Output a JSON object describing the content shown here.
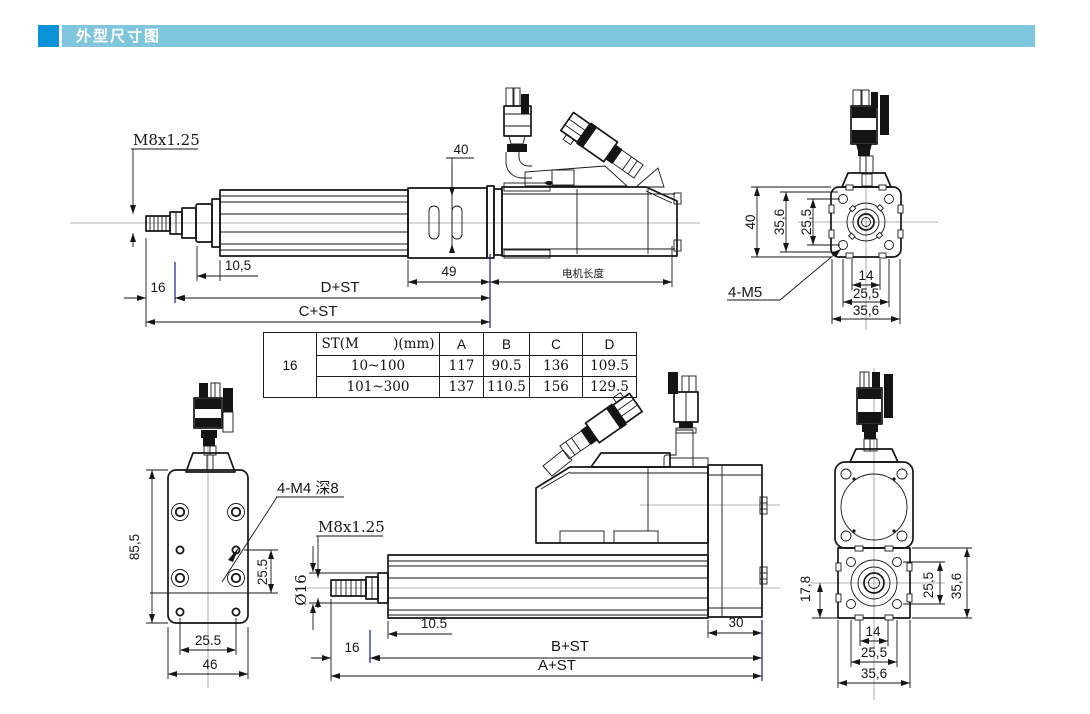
{
  "header": {
    "title": "外型尺寸图"
  },
  "colors": {
    "accent_blue": "#0a93d8",
    "bar_blue": "#7fc5dc",
    "line": "#161616",
    "navy_mark": "#2a2aa4"
  },
  "drawing": {
    "top_side": {
      "thread_label": "M8x1.25",
      "dim_40": "40",
      "dim_10_5": "10,5",
      "dim_16": "16",
      "dim_49": "49",
      "motor_length_label": "电机长度",
      "dim_d_st": "D+ST",
      "dim_c_st": "C+ST"
    },
    "top_end": {
      "dim_40": "40",
      "dim_35_6_left": "35,6",
      "dim_25_5_left": "25,5",
      "dim_14": "14",
      "dim_25_5_bottom": "25,5",
      "dim_35_6_bottom": "35,6",
      "holes_label": "4-M5"
    },
    "spec_table": {
      "size_label": "16",
      "col_stroke": "ST(M        )(mm)",
      "col_a": "A",
      "col_b": "B",
      "col_c": "C",
      "col_d": "D",
      "rows": [
        {
          "stroke": "10~100",
          "a": "117",
          "b": "90.5",
          "c": "136",
          "d": "109.5"
        },
        {
          "stroke": "101~300",
          "a": "137",
          "b": "110.5",
          "c": "156",
          "d": "129.5"
        }
      ]
    },
    "bottom_top": {
      "dim_85_5": "85,5",
      "holes_label": "4-M4 深8",
      "dim_25_5_right": "25.5",
      "dim_25_5_bottom": "25.5",
      "dim_46": "46"
    },
    "bottom_side": {
      "thread_label": "M8x1.25",
      "dia_label": "Ø16",
      "dim_10_5": "10.5",
      "dim_16": "16",
      "dim_b_st": "B+ST",
      "dim_a_st": "A+ST",
      "dim_30": "30"
    },
    "bottom_end": {
      "dim_17_8": "17,8",
      "dim_25_5_right": "25,5",
      "dim_35_6_right": "35,6",
      "dim_14": "14",
      "dim_25_5_bottom": "25,5",
      "dim_35_6_bottom": "35,6"
    }
  }
}
